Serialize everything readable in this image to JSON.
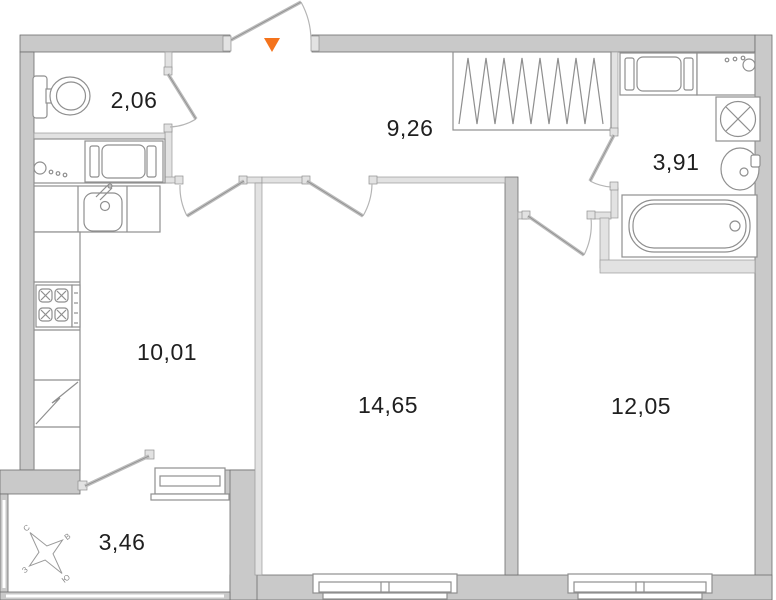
{
  "floorplan": {
    "rooms": {
      "wc": {
        "area": "2,06"
      },
      "hallway": {
        "area": "9,26"
      },
      "bathroom": {
        "area": "3,91"
      },
      "kitchen": {
        "area": "10,01"
      },
      "living_room": {
        "area": "14,65"
      },
      "bedroom": {
        "area": "12,05"
      },
      "balcony": {
        "area": "3,46"
      }
    },
    "compass": {
      "north": "С",
      "east": "В",
      "south": "Ю",
      "west": "З"
    },
    "colors": {
      "background": "#ffffff",
      "outer_wall": "#c9c9c9",
      "inner_wall": "#e2e2e2",
      "fixture_stroke": "#8f8f8f",
      "entrance_marker": "#f4731c",
      "label_text": "#1f1f1f"
    }
  }
}
